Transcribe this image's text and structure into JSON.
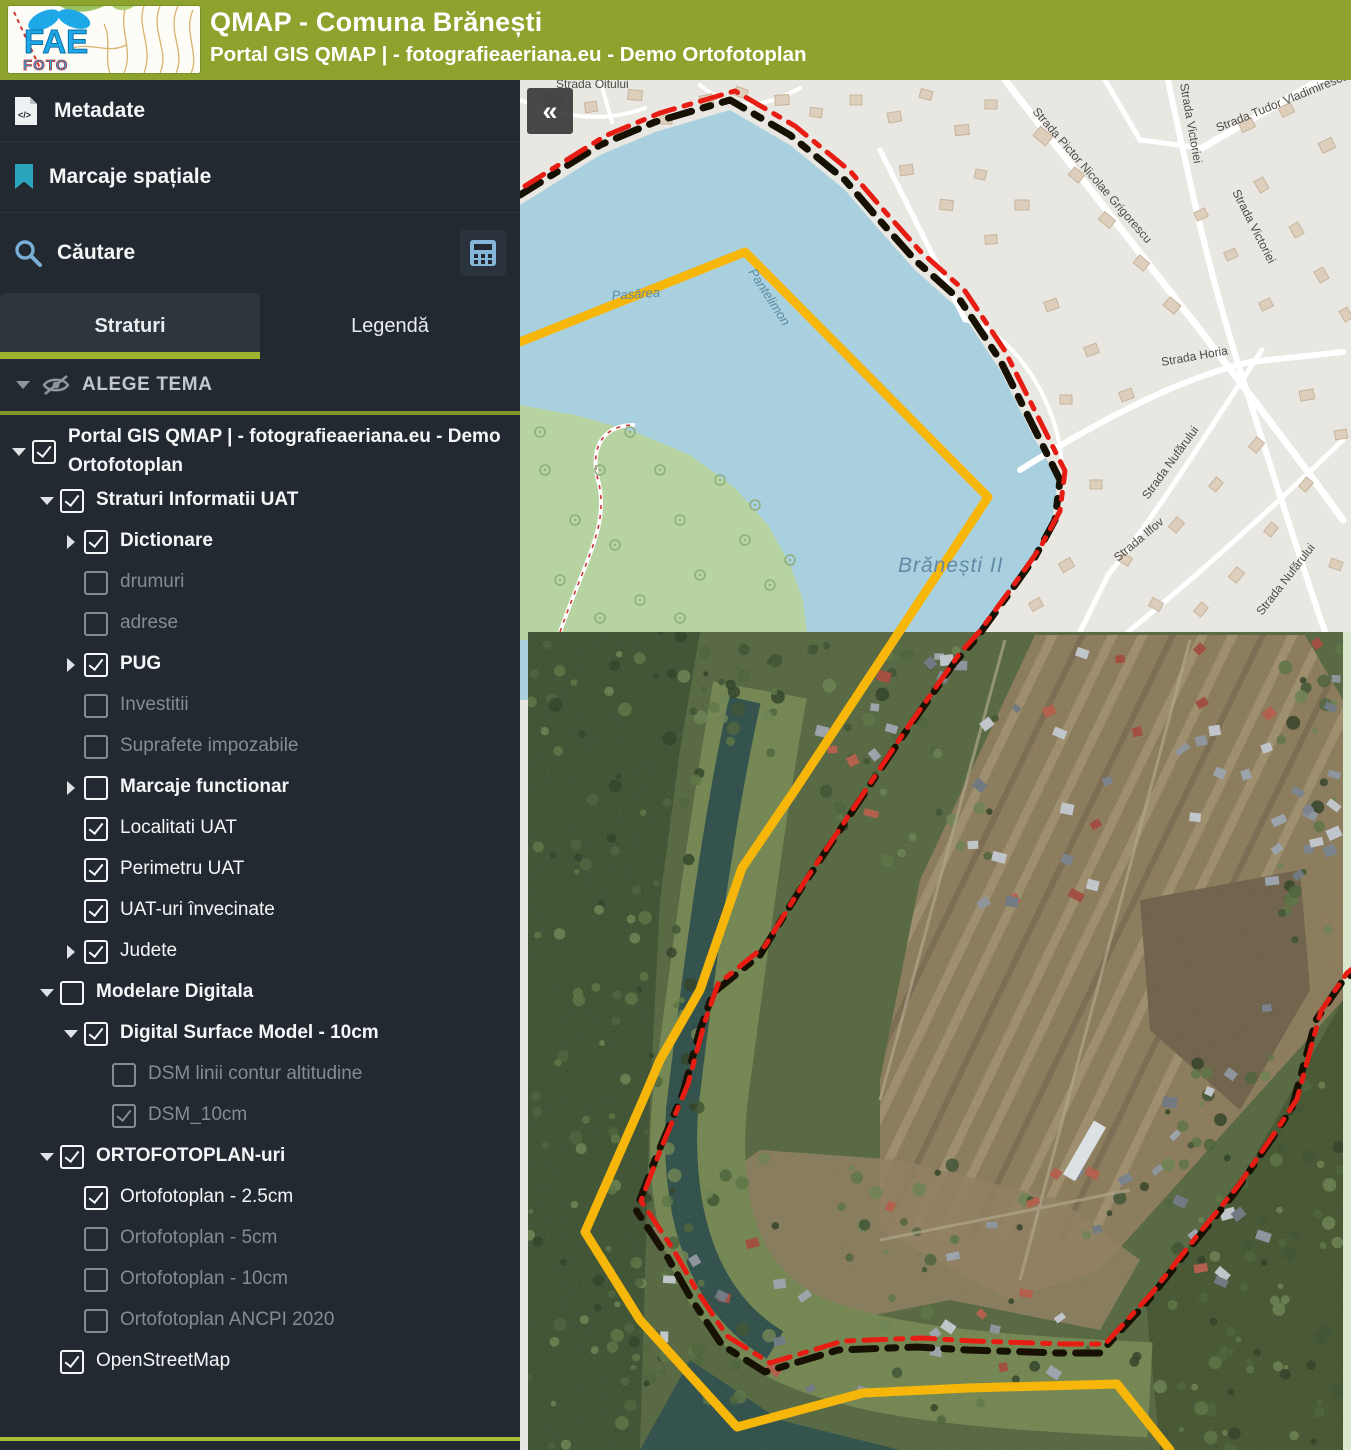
{
  "header": {
    "title": "QMAP - Comuna Brănești",
    "subtitle": "Portal GIS QMAP | - fotografieaeriana.eu - Demo Ortofotoplan",
    "logo": {
      "line1": "FAE",
      "line2": "FOTO"
    }
  },
  "sidebar": {
    "menu": [
      {
        "label": "Metadate",
        "icon": "code-file-icon"
      },
      {
        "label": "Marcaje spațiale",
        "icon": "bookmark-icon"
      },
      {
        "label": "Căutare",
        "icon": "search-icon",
        "trailing_icon": "calculator-icon"
      }
    ],
    "tabs": [
      {
        "label": "Straturi",
        "active": true
      },
      {
        "label": "Legendă",
        "active": false
      }
    ],
    "theme_selector": {
      "label": "ALEGE TEMA",
      "icon": "eye-off-icon"
    },
    "tree": [
      {
        "label": "Portal GIS QMAP | - fotografieaeriana.eu - Demo Ortofotoplan",
        "level": 1,
        "caret": "down",
        "checked": true,
        "bold": true,
        "tone": "white"
      },
      {
        "label": "Straturi Informatii UAT",
        "level": 2,
        "caret": "down",
        "checked": true,
        "bold": true,
        "tone": "white"
      },
      {
        "label": "Dictionare",
        "level": 3,
        "caret": "right",
        "checked": true,
        "bold": true,
        "tone": "white"
      },
      {
        "label": "drumuri",
        "level": 3,
        "caret": "none",
        "checked": false,
        "bold": false,
        "tone": "gray"
      },
      {
        "label": "adrese",
        "level": 3,
        "caret": "none",
        "checked": false,
        "bold": false,
        "tone": "gray"
      },
      {
        "label": "PUG",
        "level": 3,
        "caret": "right",
        "checked": true,
        "bold": true,
        "tone": "white"
      },
      {
        "label": "Investitii",
        "level": 3,
        "caret": "none",
        "checked": false,
        "bold": false,
        "tone": "gray"
      },
      {
        "label": "Suprafete impozabile",
        "level": 3,
        "caret": "none",
        "checked": false,
        "bold": false,
        "tone": "gray"
      },
      {
        "label": "Marcaje functionar",
        "level": 3,
        "caret": "right",
        "checked": false,
        "bold": true,
        "tone": "white"
      },
      {
        "label": "Localitati UAT",
        "level": 3,
        "caret": "none",
        "checked": true,
        "bold": false,
        "tone": "white"
      },
      {
        "label": "Perimetru UAT",
        "level": 3,
        "caret": "none",
        "checked": true,
        "bold": false,
        "tone": "white"
      },
      {
        "label": "UAT-uri învecinate",
        "level": 3,
        "caret": "none",
        "checked": true,
        "bold": false,
        "tone": "white"
      },
      {
        "label": "Judete",
        "level": 3,
        "caret": "right",
        "checked": true,
        "bold": false,
        "tone": "white"
      },
      {
        "label": "Modelare Digitala",
        "level": 2,
        "caret": "down",
        "checked": false,
        "bold": true,
        "tone": "white"
      },
      {
        "label": "Digital Surface Model - 10cm",
        "level": 3,
        "caret": "down",
        "checked": true,
        "bold": true,
        "tone": "white"
      },
      {
        "label": "DSM linii contur altitudine",
        "level": 4,
        "caret": "none",
        "checked": false,
        "bold": false,
        "tone": "gray"
      },
      {
        "label": "DSM_10cm",
        "level": 4,
        "caret": "none",
        "checked": true,
        "bold": false,
        "tone": "gray"
      },
      {
        "label": "ORTOFOTOPLAN-uri",
        "level": 2,
        "caret": "down",
        "checked": true,
        "bold": true,
        "tone": "white"
      },
      {
        "label": "Ortofotoplan - 2.5cm",
        "level": 3,
        "caret": "none",
        "checked": true,
        "bold": false,
        "tone": "white"
      },
      {
        "label": "Ortofotoplan - 5cm",
        "level": 3,
        "caret": "none",
        "checked": false,
        "bold": false,
        "tone": "gray"
      },
      {
        "label": "Ortofotoplan - 10cm",
        "level": 3,
        "caret": "none",
        "checked": false,
        "bold": false,
        "tone": "gray"
      },
      {
        "label": "Ortofotoplan ANCPI 2020",
        "level": 3,
        "caret": "none",
        "checked": false,
        "bold": false,
        "tone": "gray"
      },
      {
        "label": "OpenStreetMap",
        "level": 2,
        "caret": "none",
        "checked": true,
        "bold": false,
        "tone": "white"
      }
    ]
  },
  "map": {
    "collapse_label": "«",
    "labels": [
      {
        "text": "Strada Oitului",
        "x": 556,
        "y": 88,
        "rot": 0,
        "cls": "street-lb"
      },
      {
        "text": "Pasărea",
        "x": 612,
        "y": 300,
        "rot": -4,
        "cls": "water-lb"
      },
      {
        "text": "Pantelimon",
        "x": 748,
        "y": 272,
        "rot": 57,
        "cls": "water-lb"
      },
      {
        "text": "Brănești II",
        "x": 898,
        "y": 572,
        "rot": 0,
        "cls": "place-lb"
      },
      {
        "text": "Strada Pictor Nicolae Grigorescu",
        "x": 1032,
        "y": 112,
        "rot": 49,
        "cls": "street-lb"
      },
      {
        "text": "Strada Victoriei",
        "x": 1180,
        "y": 84,
        "rot": 80,
        "cls": "street-lb"
      },
      {
        "text": "Strada Tudor Vladimirescu",
        "x": 1218,
        "y": 132,
        "rot": -22,
        "cls": "street-lb"
      },
      {
        "text": "Strada Victoriei",
        "x": 1232,
        "y": 192,
        "rot": 63,
        "cls": "street-lb"
      },
      {
        "text": "Strada Horia",
        "x": 1162,
        "y": 366,
        "rot": -10,
        "cls": "street-lb"
      },
      {
        "text": "Strada Nufărului",
        "x": 1148,
        "y": 500,
        "rot": -54,
        "cls": "street-lb"
      },
      {
        "text": "Strada Ilfov",
        "x": 1118,
        "y": 562,
        "rot": -40,
        "cls": "street-lb"
      },
      {
        "text": "Strada Nufărului",
        "x": 1262,
        "y": 616,
        "rot": -52,
        "cls": "street-lb"
      }
    ],
    "colors": {
      "header_green": "#8da32e",
      "sidebar_bg": "#222930",
      "tab_underline": "#9db32d",
      "boundary_yellow": "#f6b60a",
      "boundary_red": "#e71c13",
      "boundary_black": "#171103",
      "lake_blue": "#a9d0de",
      "osm_forest_green": "#b7d3a2"
    }
  }
}
